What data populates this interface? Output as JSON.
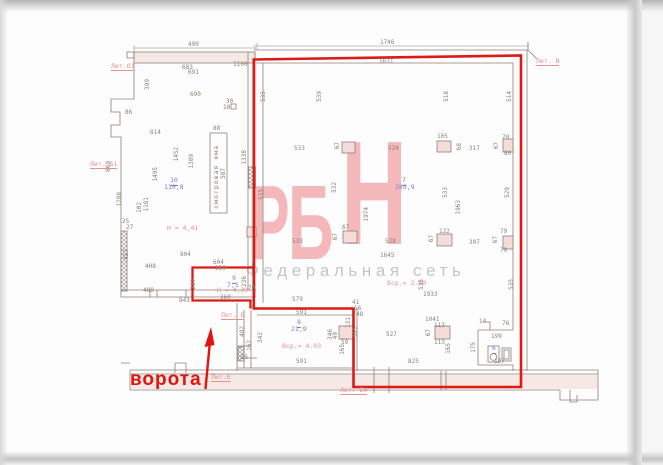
{
  "watermark": {
    "letter_1": "Р",
    "letter_2": "Б",
    "letter_3": "Н",
    "subtitle": "Федеральная сеть"
  },
  "annotation": {
    "gate_label": "ворота"
  },
  "colors": {
    "highlight_outline": "#dc1b15",
    "gate_red": "#e01510",
    "wall_line": "#8d8178",
    "pink_fill": "#f6e8e4",
    "room_label_blue": "#7d7dc8",
    "annotation_soft_red": "#e8928d",
    "watermark_pink": "#f4b8bb",
    "watermark_gray": "#c6c5c5"
  },
  "rooms": [
    {
      "number": "10",
      "area": "110,8",
      "height_note": "Н = 4,41"
    },
    {
      "number": "9",
      "area": "7,5",
      "height_note": "Н = 4,39"
    },
    {
      "number": "7",
      "area": "289,9",
      "height_note": "Вср.= 3.90"
    },
    {
      "number": "8",
      "area": "21,9",
      "height_note": "Вср.= 4.03"
    },
    {
      "number": "6",
      "area": "",
      "height_note": ""
    }
  ],
  "labels": [
    {
      "t": "490",
      "x": 188,
      "y": 42,
      "c": "d"
    },
    {
      "t": "1746",
      "x": 380,
      "y": 40,
      "c": "d"
    },
    {
      "t": "683",
      "x": 182,
      "y": 65,
      "c": "d"
    },
    {
      "t": "691",
      "x": 188,
      "y": 70,
      "c": "d"
    },
    {
      "t": "690",
      "x": 190,
      "y": 92,
      "c": "d"
    },
    {
      "t": "1611",
      "x": 379,
      "y": 59,
      "c": "d"
    },
    {
      "t": "1100",
      "x": 233,
      "y": 62,
      "c": "d"
    },
    {
      "t": "399",
      "x": 145,
      "y": 79,
      "c": "v"
    },
    {
      "t": "86",
      "x": 125,
      "y": 110,
      "c": "d"
    },
    {
      "t": "30",
      "x": 226,
      "y": 99,
      "c": "d"
    },
    {
      "t": "10",
      "x": 223,
      "y": 105,
      "c": "d"
    },
    {
      "t": "814",
      "x": 150,
      "y": 130,
      "c": "d"
    },
    {
      "t": "88",
      "x": 213,
      "y": 126,
      "c": "d"
    },
    {
      "t": "1452",
      "x": 174,
      "y": 147,
      "c": "v"
    },
    {
      "t": "1309",
      "x": 189,
      "y": 154,
      "c": "v"
    },
    {
      "t": "1495",
      "x": 153,
      "y": 167,
      "c": "v"
    },
    {
      "t": "669",
      "x": 106,
      "y": 161,
      "c": "v"
    },
    {
      "t": "1338",
      "x": 242,
      "y": 150,
      "c": "v"
    },
    {
      "t": "587",
      "x": 221,
      "y": 168,
      "c": "v"
    },
    {
      "t": "смотровая яма",
      "x": 213,
      "y": 145,
      "c": "pit"
    },
    {
      "t": "10",
      "x": 170,
      "y": 177,
      "c": "bu"
    },
    {
      "t": "110,8",
      "x": 164,
      "y": 184,
      "c": "b"
    },
    {
      "t": "1288",
      "x": 117,
      "y": 192,
      "c": "v"
    },
    {
      "t": "1181",
      "x": 144,
      "y": 197,
      "c": "v"
    },
    {
      "t": "102",
      "x": 137,
      "y": 202,
      "c": "v"
    },
    {
      "t": "Н = 4,41",
      "x": 167,
      "y": 225,
      "c": "r"
    },
    {
      "t": "25",
      "x": 122,
      "y": 219,
      "c": "d"
    },
    {
      "t": "27",
      "x": 126,
      "y": 225,
      "c": "d"
    },
    {
      "t": "457",
      "x": 124,
      "y": 249,
      "c": "v"
    },
    {
      "t": "804",
      "x": 180,
      "y": 252,
      "c": "d"
    },
    {
      "t": "408",
      "x": 145,
      "y": 264,
      "c": "d"
    },
    {
      "t": "408",
      "x": 143,
      "y": 288,
      "c": "d"
    },
    {
      "t": "843",
      "x": 179,
      "y": 298,
      "c": "d"
    },
    {
      "t": "604",
      "x": 213,
      "y": 260,
      "c": "d"
    },
    {
      "t": "359",
      "x": 215,
      "y": 266,
      "c": "d"
    },
    {
      "t": "9",
      "x": 232,
      "y": 275,
      "c": "bu"
    },
    {
      "t": "7,5",
      "x": 227,
      "y": 282,
      "c": "b"
    },
    {
      "t": "Н = 4,39",
      "x": 217,
      "y": 287,
      "c": "r"
    },
    {
      "t": "289",
      "x": 191,
      "y": 279,
      "c": "v"
    },
    {
      "t": "236",
      "x": 242,
      "y": 276,
      "c": "v"
    },
    {
      "t": "70",
      "x": 248,
      "y": 286,
      "c": "d"
    },
    {
      "t": "360",
      "x": 220,
      "y": 295,
      "c": "d"
    },
    {
      "t": "535",
      "x": 261,
      "y": 91,
      "c": "v"
    },
    {
      "t": "539",
      "x": 317,
      "y": 91,
      "c": "v"
    },
    {
      "t": "518",
      "x": 444,
      "y": 91,
      "c": "v"
    },
    {
      "t": "514",
      "x": 507,
      "y": 91,
      "c": "v"
    },
    {
      "t": "533",
      "x": 294,
      "y": 146,
      "c": "d"
    },
    {
      "t": "67",
      "x": 335,
      "y": 142,
      "c": "v"
    },
    {
      "t": "524",
      "x": 388,
      "y": 146,
      "c": "d"
    },
    {
      "t": "105",
      "x": 437,
      "y": 134,
      "c": "d"
    },
    {
      "t": "68",
      "x": 457,
      "y": 143,
      "c": "v"
    },
    {
      "t": "317",
      "x": 469,
      "y": 146,
      "c": "d"
    },
    {
      "t": "70",
      "x": 502,
      "y": 135,
      "c": "d"
    },
    {
      "t": "67",
      "x": 494,
      "y": 142,
      "c": "v"
    },
    {
      "t": "80",
      "x": 504,
      "y": 151,
      "c": "d"
    },
    {
      "t": "532",
      "x": 332,
      "y": 182,
      "c": "v"
    },
    {
      "t": "1974",
      "x": 364,
      "y": 207,
      "c": "v"
    },
    {
      "t": "7",
      "x": 402,
      "y": 177,
      "c": "bu"
    },
    {
      "t": "289,9",
      "x": 395,
      "y": 184,
      "c": "b"
    },
    {
      "t": "533",
      "x": 443,
      "y": 187,
      "c": "v"
    },
    {
      "t": "1963",
      "x": 456,
      "y": 200,
      "c": "v"
    },
    {
      "t": "529",
      "x": 505,
      "y": 187,
      "c": "v"
    },
    {
      "t": "535",
      "x": 259,
      "y": 189,
      "c": "v"
    },
    {
      "t": "533",
      "x": 292,
      "y": 239,
      "c": "d"
    },
    {
      "t": "67",
      "x": 342,
      "y": 225,
      "c": "d"
    },
    {
      "t": "67",
      "x": 333,
      "y": 233,
      "c": "v"
    },
    {
      "t": "122",
      "x": 439,
      "y": 229,
      "c": "d"
    },
    {
      "t": "67",
      "x": 429,
      "y": 235,
      "c": "v"
    },
    {
      "t": "307",
      "x": 469,
      "y": 240,
      "c": "d"
    },
    {
      "t": "79",
      "x": 500,
      "y": 229,
      "c": "d"
    },
    {
      "t": "67",
      "x": 493,
      "y": 236,
      "c": "v"
    },
    {
      "t": "79",
      "x": 500,
      "y": 248,
      "c": "d"
    },
    {
      "t": "528",
      "x": 385,
      "y": 239,
      "c": "d"
    },
    {
      "t": "1645",
      "x": 380,
      "y": 253,
      "c": "d"
    },
    {
      "t": "Вср.= 3.90",
      "x": 387,
      "y": 280,
      "c": "r"
    },
    {
      "t": "535",
      "x": 419,
      "y": 279,
      "c": "v"
    },
    {
      "t": "1933",
      "x": 423,
      "y": 292,
      "c": "d"
    },
    {
      "t": "535",
      "x": 509,
      "y": 279,
      "c": "v"
    },
    {
      "t": "579",
      "x": 292,
      "y": 297,
      "c": "d"
    },
    {
      "t": "591",
      "x": 296,
      "y": 310,
      "c": "d"
    },
    {
      "t": "41",
      "x": 352,
      "y": 300,
      "c": "d"
    },
    {
      "t": "16",
      "x": 354,
      "y": 306,
      "c": "d"
    },
    {
      "t": "48",
      "x": 356,
      "y": 312,
      "c": "d"
    },
    {
      "t": "131",
      "x": 346,
      "y": 317,
      "c": "v"
    },
    {
      "t": "8",
      "x": 297,
      "y": 319,
      "c": "bu"
    },
    {
      "t": "21,9",
      "x": 291,
      "y": 326,
      "c": "b"
    },
    {
      "t": "Вср.= 4.03",
      "x": 282,
      "y": 343,
      "c": "r"
    },
    {
      "t": "591",
      "x": 296,
      "y": 359,
      "c": "d"
    },
    {
      "t": "482",
      "x": 240,
      "y": 326,
      "c": "v"
    },
    {
      "t": "342",
      "x": 258,
      "y": 332,
      "c": "v"
    },
    {
      "t": "162",
      "x": 247,
      "y": 340,
      "c": "v"
    },
    {
      "t": "55",
      "x": 241,
      "y": 355,
      "c": "d"
    },
    {
      "t": "346",
      "x": 328,
      "y": 329,
      "c": "v"
    },
    {
      "t": "49",
      "x": 333,
      "y": 332,
      "c": "v"
    },
    {
      "t": "59",
      "x": 341,
      "y": 340,
      "c": "d"
    },
    {
      "t": "165",
      "x": 340,
      "y": 344,
      "c": "v"
    },
    {
      "t": "365",
      "x": 353,
      "y": 327,
      "c": "v"
    },
    {
      "t": "527",
      "x": 386,
      "y": 332,
      "c": "d"
    },
    {
      "t": "1041",
      "x": 425,
      "y": 317,
      "c": "d"
    },
    {
      "t": "113",
      "x": 434,
      "y": 323,
      "c": "d"
    },
    {
      "t": "67",
      "x": 426,
      "y": 329,
      "c": "v"
    },
    {
      "t": "113",
      "x": 434,
      "y": 340,
      "c": "d"
    },
    {
      "t": "165",
      "x": 446,
      "y": 343,
      "c": "v"
    },
    {
      "t": "825",
      "x": 408,
      "y": 359,
      "c": "d"
    },
    {
      "t": "14",
      "x": 479,
      "y": 319,
      "c": "d"
    },
    {
      "t": "76",
      "x": 502,
      "y": 321,
      "c": "d"
    },
    {
      "t": "199",
      "x": 491,
      "y": 334,
      "c": "d"
    },
    {
      "t": "175",
      "x": 471,
      "y": 342,
      "c": "v"
    },
    {
      "t": "6",
      "x": 492,
      "y": 345,
      "c": "bu"
    },
    {
      "t": "197",
      "x": 494,
      "y": 359,
      "c": "d"
    },
    {
      "t": "Лит.б1",
      "x": 111,
      "y": 63,
      "c": "l"
    },
    {
      "t": "Лит. Б1",
      "x": 90,
      "y": 161,
      "c": "l"
    },
    {
      "t": "Лит. В",
      "x": 536,
      "y": 58,
      "c": "l"
    },
    {
      "t": "Лит. Б",
      "x": 221,
      "y": 312,
      "c": "l"
    },
    {
      "t": "Лит.б",
      "x": 211,
      "y": 374,
      "c": "l"
    },
    {
      "t": "Лит. Б4",
      "x": 340,
      "y": 387,
      "c": "l"
    }
  ]
}
